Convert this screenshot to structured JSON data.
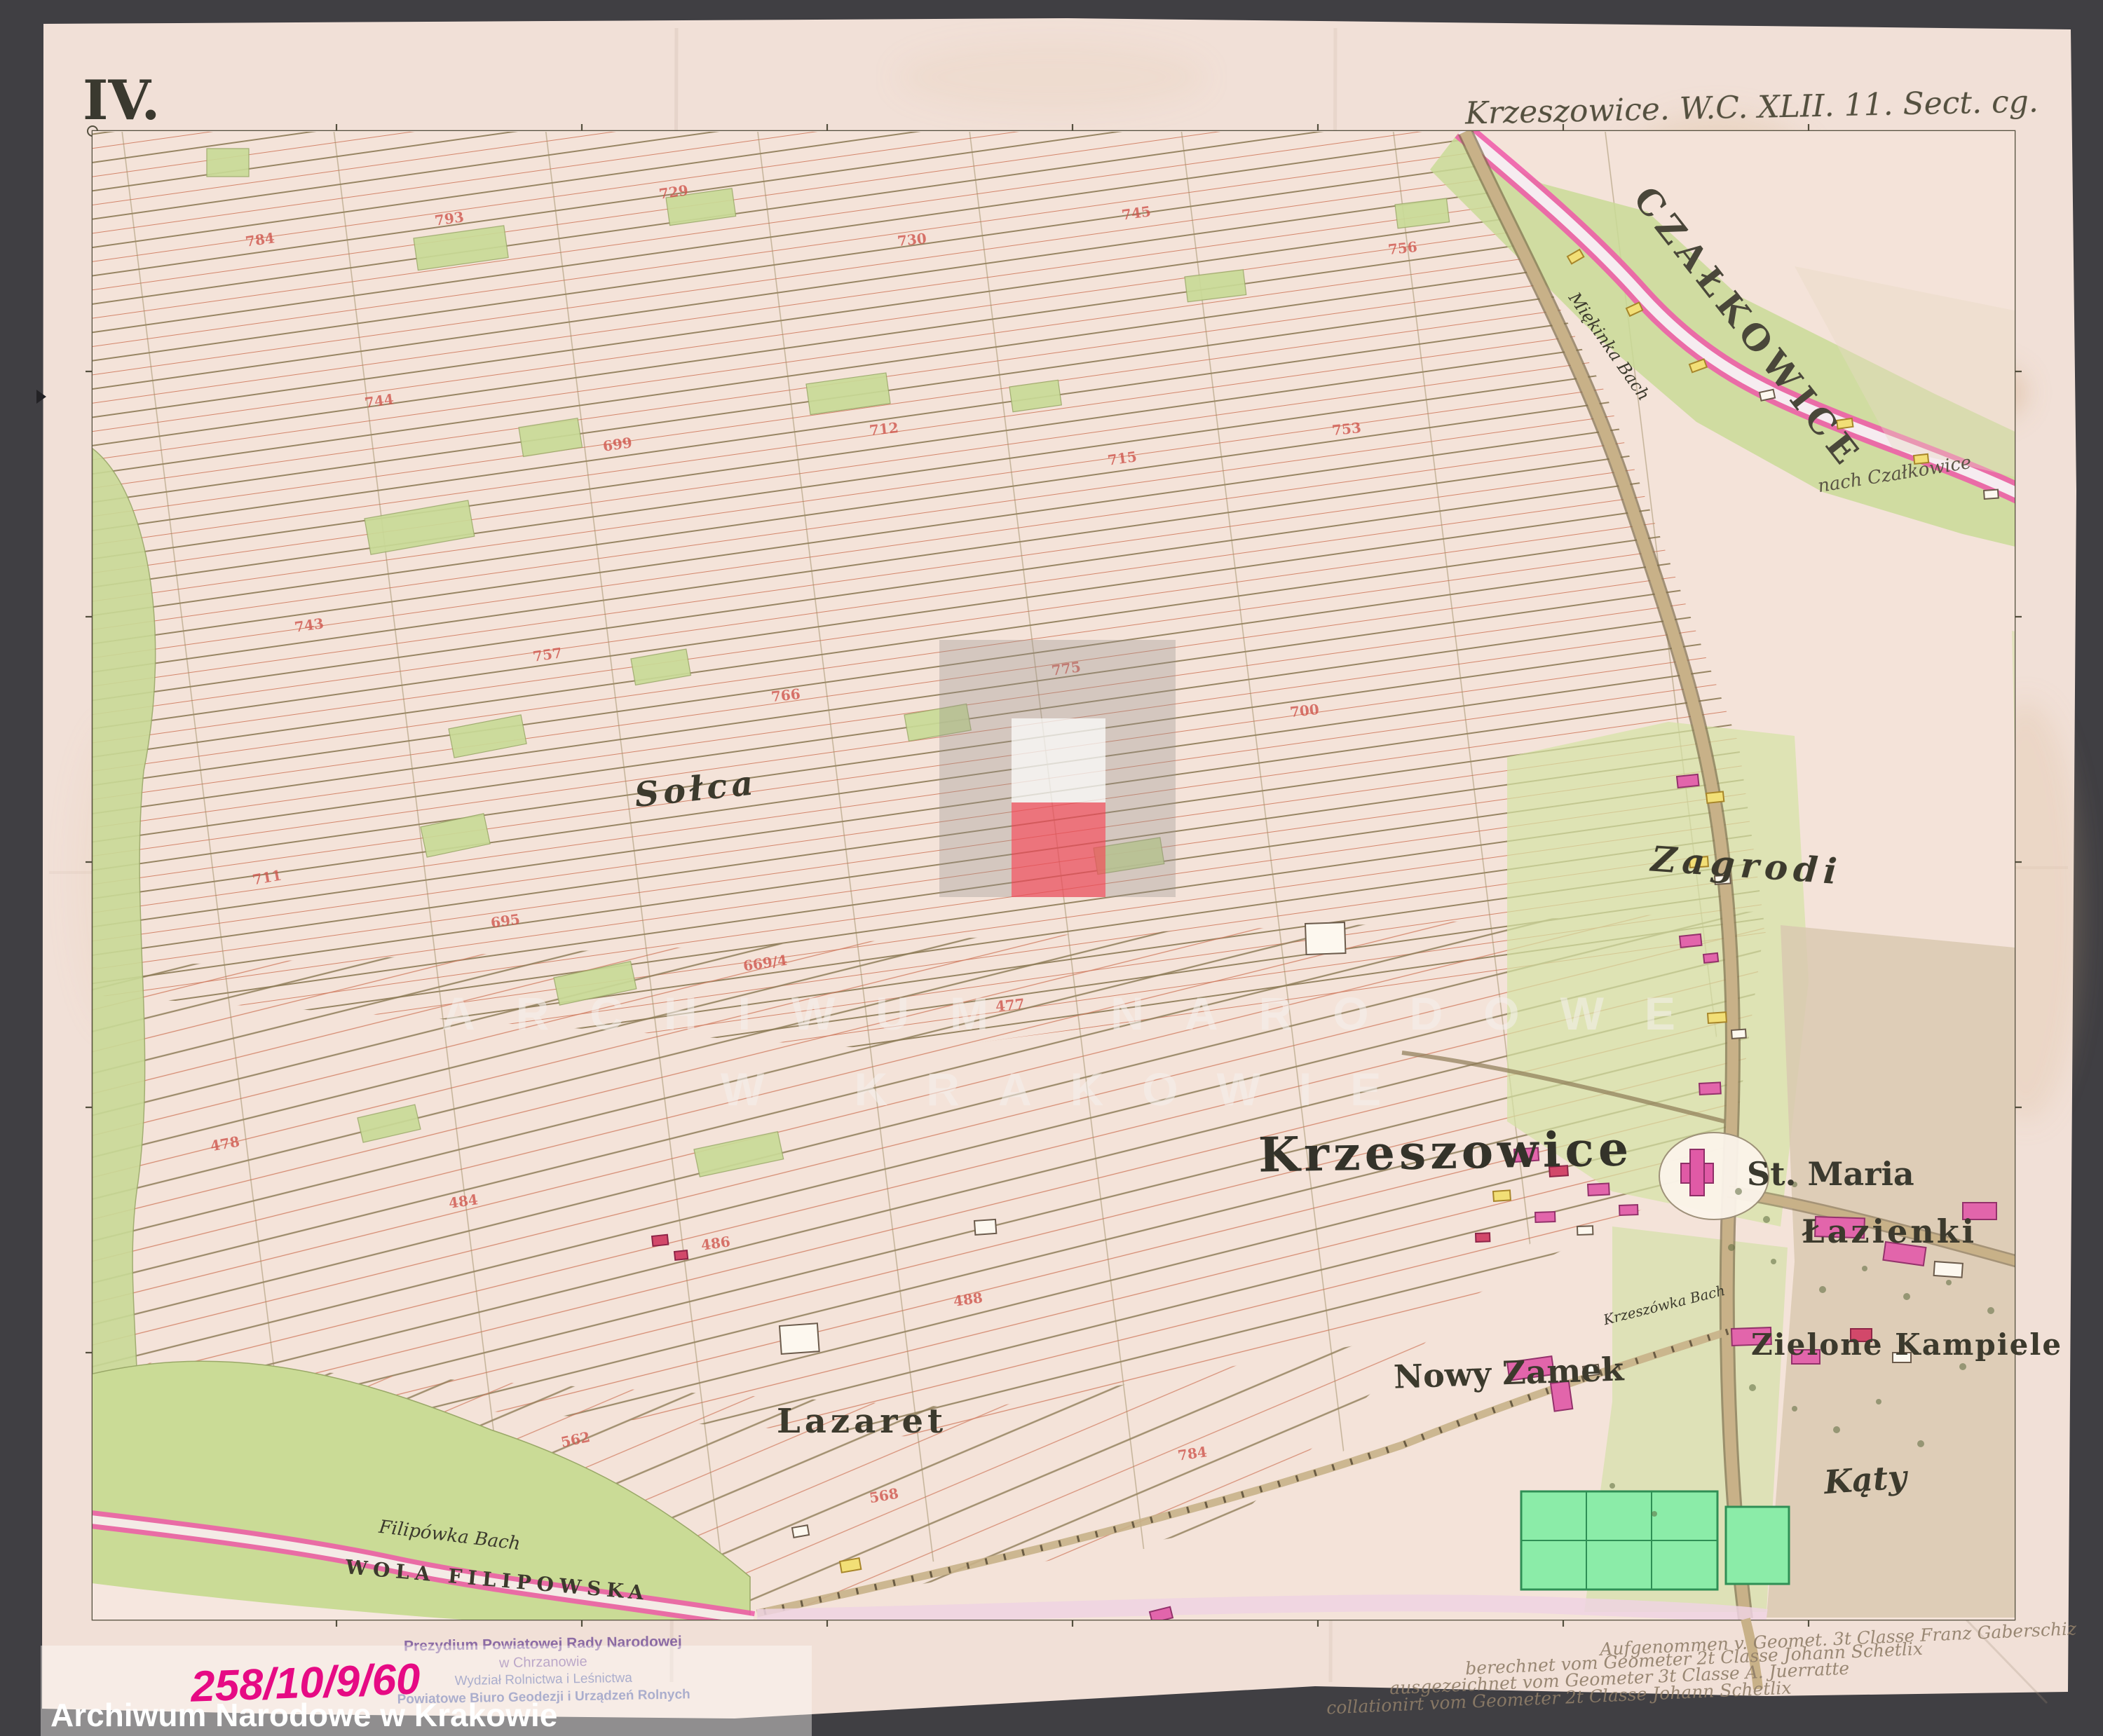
{
  "sheet": {
    "number": "IV.",
    "title": "Krzeszowice. W.C. XLII. 11. Sect. cg."
  },
  "map": {
    "labels": {
      "czalkowice": "CZAŁKOWICE",
      "solca": "Sołca",
      "zagrodi": "Zagrodi",
      "krzeszowice": "Krzeszowice",
      "st_maria": "St. Maria",
      "lazienki": "Łazienki",
      "zielone_kampiele": "Zielone Kampiele",
      "nowy_zamek": "Nowy Zamek",
      "lazaret": "Lazaret",
      "katy": "Kąty",
      "wola_filipowska": "WOLA FILIPOWSKA",
      "filipowka_bach": "Filipówka Bach",
      "miekinka_bach": "Miękinka Bach",
      "krzeszowka_bach": "Krzeszówka Bach",
      "nach_czalkowice": "nach Czałkowice"
    },
    "parcel_numbers_sample": [
      "784",
      "793",
      "729",
      "730",
      "745",
      "756",
      "744",
      "699",
      "712",
      "715",
      "753",
      "743",
      "757",
      "766",
      "775",
      "700",
      "711",
      "695",
      "669/4",
      "477",
      "478",
      "484",
      "486",
      "488",
      "562",
      "568"
    ],
    "palette": {
      "paper": "#f1e0d7",
      "field_green": "#c9da97",
      "garden_green": "#8beca8",
      "boundary_magenta": "#ea4fa2",
      "building_pink": "#e265ab",
      "building_yellow": "#f2df76",
      "road_tan": "#c8b188",
      "frame_ink": "#55503f",
      "parcel_red": "#cf544c"
    }
  },
  "annotations": {
    "surveyor_lines": [
      "Aufgenommen v. Geomet. 3t Classe  Franz Gaberschiz",
      "berechnet vom Geometer 2t Classe  Johann Schetlix",
      "ausgezeichnet vom Geometer 3t Classe  A. Juerratte",
      "collationirt vom Geometer 2t Classe  Johann Schetlix"
    ]
  },
  "stamp": {
    "line1": "Prezydium Powiatowej Rady Narodowej",
    "line2": "w Chrzanowie",
    "line3": "Wydział Rolnictwa i Leśnictwa",
    "line4": "Powiatowe Biuro Geodezji i Urządzeń Rolnych"
  },
  "footer": {
    "inventory_number": "258/10/9/60",
    "archive_name": "Archiwum Narodowe w Krakowie"
  },
  "watermark": {
    "line1": "ARCHIWUM NARODOWE",
    "line2": "W KRAKOWIE"
  }
}
